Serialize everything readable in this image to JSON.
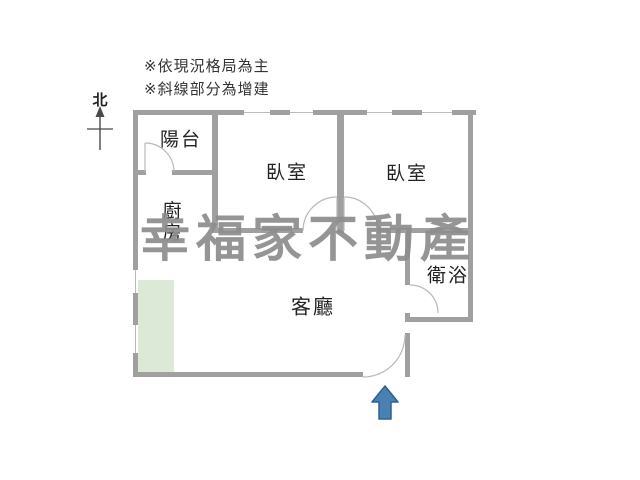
{
  "notes": {
    "line1": "※依現況格局為主",
    "line2": "※斜線部分為增建"
  },
  "compass": {
    "label": "北"
  },
  "watermark": {
    "text": "幸福家不動產",
    "color": "#8d8d8d"
  },
  "rooms": [
    {
      "id": "balcony",
      "label": "陽台"
    },
    {
      "id": "bedroom-1",
      "label": "臥室"
    },
    {
      "id": "bedroom-2",
      "label": "臥室"
    },
    {
      "id": "kitchen",
      "label": "廚房"
    },
    {
      "id": "living-room",
      "label": "客廳"
    },
    {
      "id": "bathroom",
      "label": "衛浴"
    }
  ],
  "colors": {
    "wall": "#a0a0a0",
    "window_line": "#bcbcbc",
    "door_arc": "#b9b9b9",
    "addition_fill": "#dde9d7",
    "entrance_arrow_fill": "#4b80b3",
    "entrance_arrow_border": "#2f6090",
    "text": "#222222"
  },
  "entrance_arrow": {
    "direction": "up"
  }
}
